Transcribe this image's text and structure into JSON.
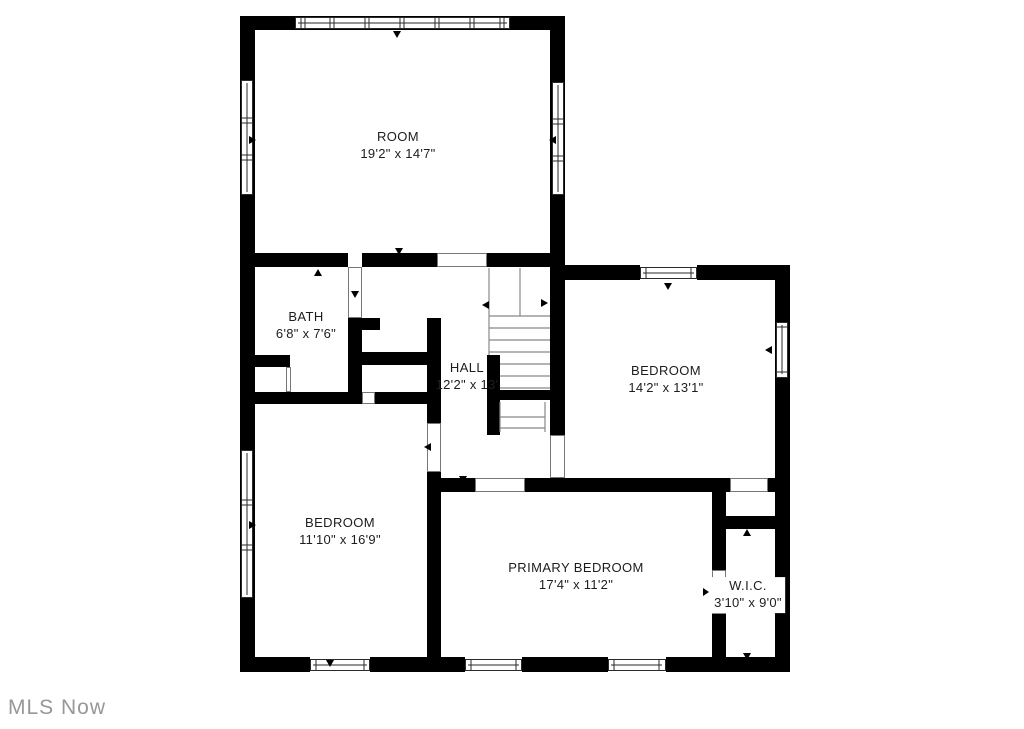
{
  "watermark": "MLS Now",
  "colors": {
    "wall": "#000000",
    "label_text": "#1d1d1d",
    "watermark_text": "#979797",
    "background": "#ffffff"
  },
  "rooms": {
    "room": {
      "name": "ROOM",
      "dims": "19'2\" x 14'7\""
    },
    "bath": {
      "name": "BATH",
      "dims": "6'8\" x 7'6\""
    },
    "hall": {
      "name": "HALL",
      "dims": "12'2\" x 13'"
    },
    "bedroom_tr": {
      "name": "BEDROOM",
      "dims": "14'2\" x 13'1\""
    },
    "bedroom_bl": {
      "name": "BEDROOM",
      "dims": "11'10\" x 16'9\""
    },
    "primary": {
      "name": "PRIMARY BEDROOM",
      "dims": "17'4\" x 11'2\""
    },
    "wic": {
      "name": "W.I.C.",
      "dims": "3'10\" x 9'0\""
    }
  }
}
